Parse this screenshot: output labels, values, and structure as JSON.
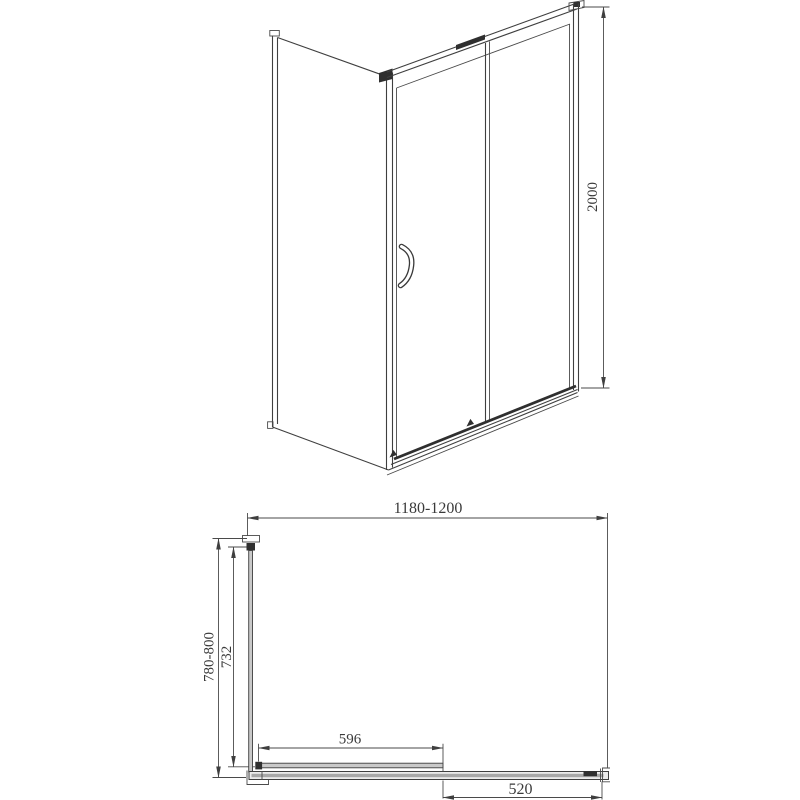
{
  "page": {
    "background": "#ffffff",
    "line_color": "#3f3f3f",
    "dark_fill": "#2f2f2f",
    "glass_fill": "#c9c9c9"
  },
  "drawing": {
    "kind": "shower-enclosure-technical-drawing",
    "dimensions": {
      "height": "2000",
      "width_range": "1180-1200",
      "depth_range": "780-800",
      "side_glass_width": "732",
      "door_panel_width": "596",
      "side_panel_width": "520"
    }
  }
}
